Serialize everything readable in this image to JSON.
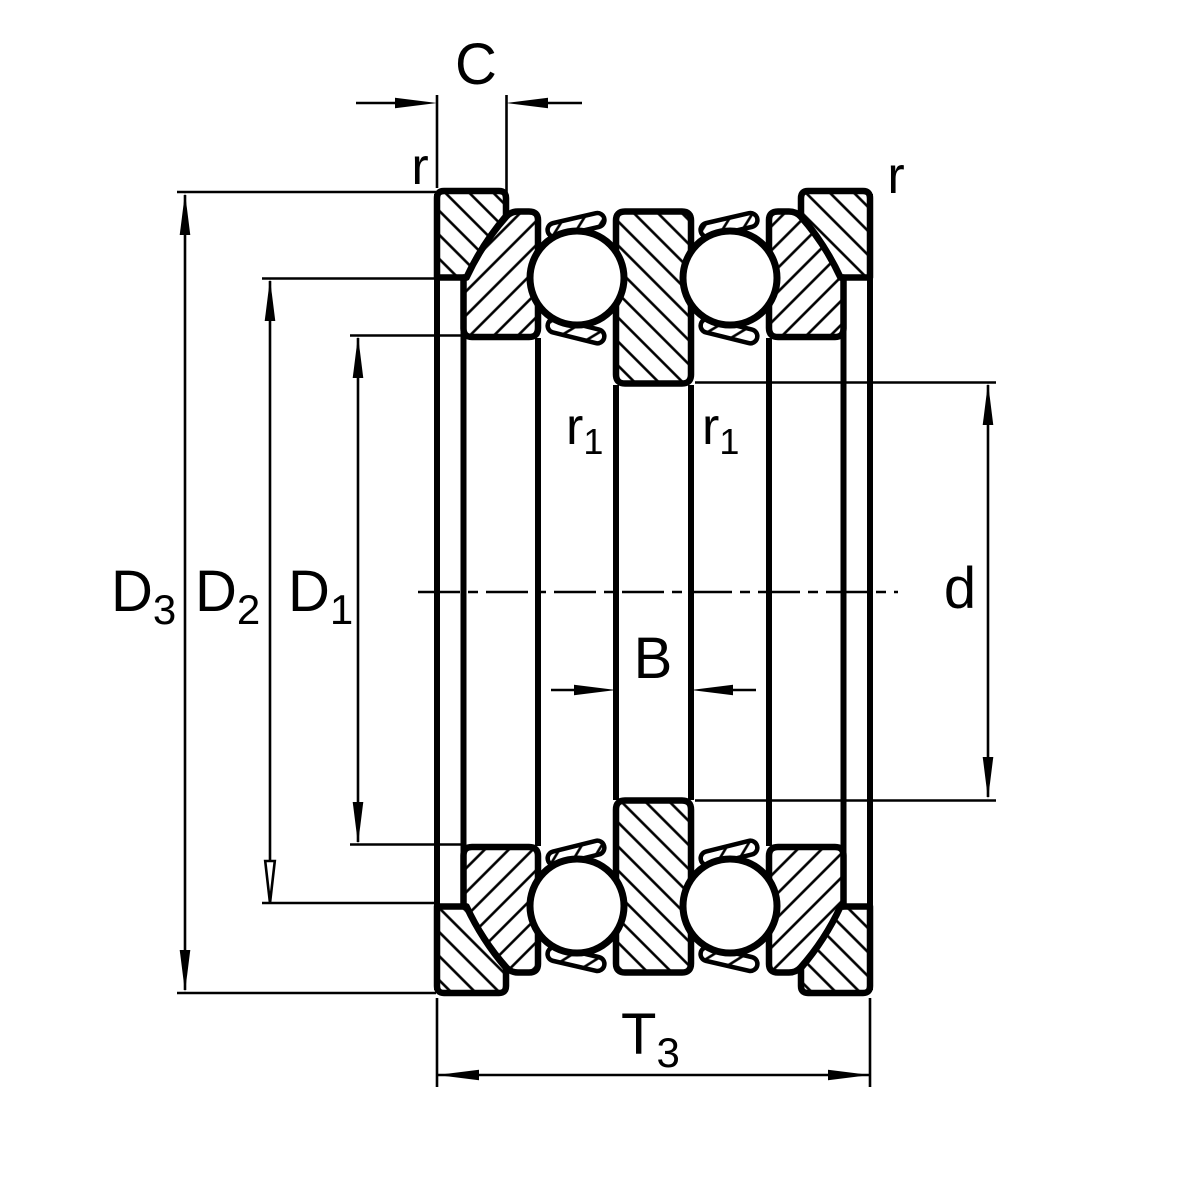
{
  "drawing": {
    "description": "Double-direction thrust ball bearing cross-section with sphered housing washers and seating washers",
    "colors": {
      "ink": "#000000",
      "paper": "#ffffff"
    },
    "labels": {
      "c": "C",
      "r_top_left": "r",
      "r_top_right": "r",
      "d3": {
        "main": "D",
        "sub": "3"
      },
      "d2": {
        "main": "D",
        "sub": "2"
      },
      "d1": {
        "main": "D",
        "sub": "1"
      },
      "b": "B",
      "r1_left": {
        "main": "r",
        "sub": "1"
      },
      "r1_right": {
        "main": "r",
        "sub": "1"
      },
      "d": "d",
      "t3": {
        "main": "T",
        "sub": "3"
      }
    }
  }
}
